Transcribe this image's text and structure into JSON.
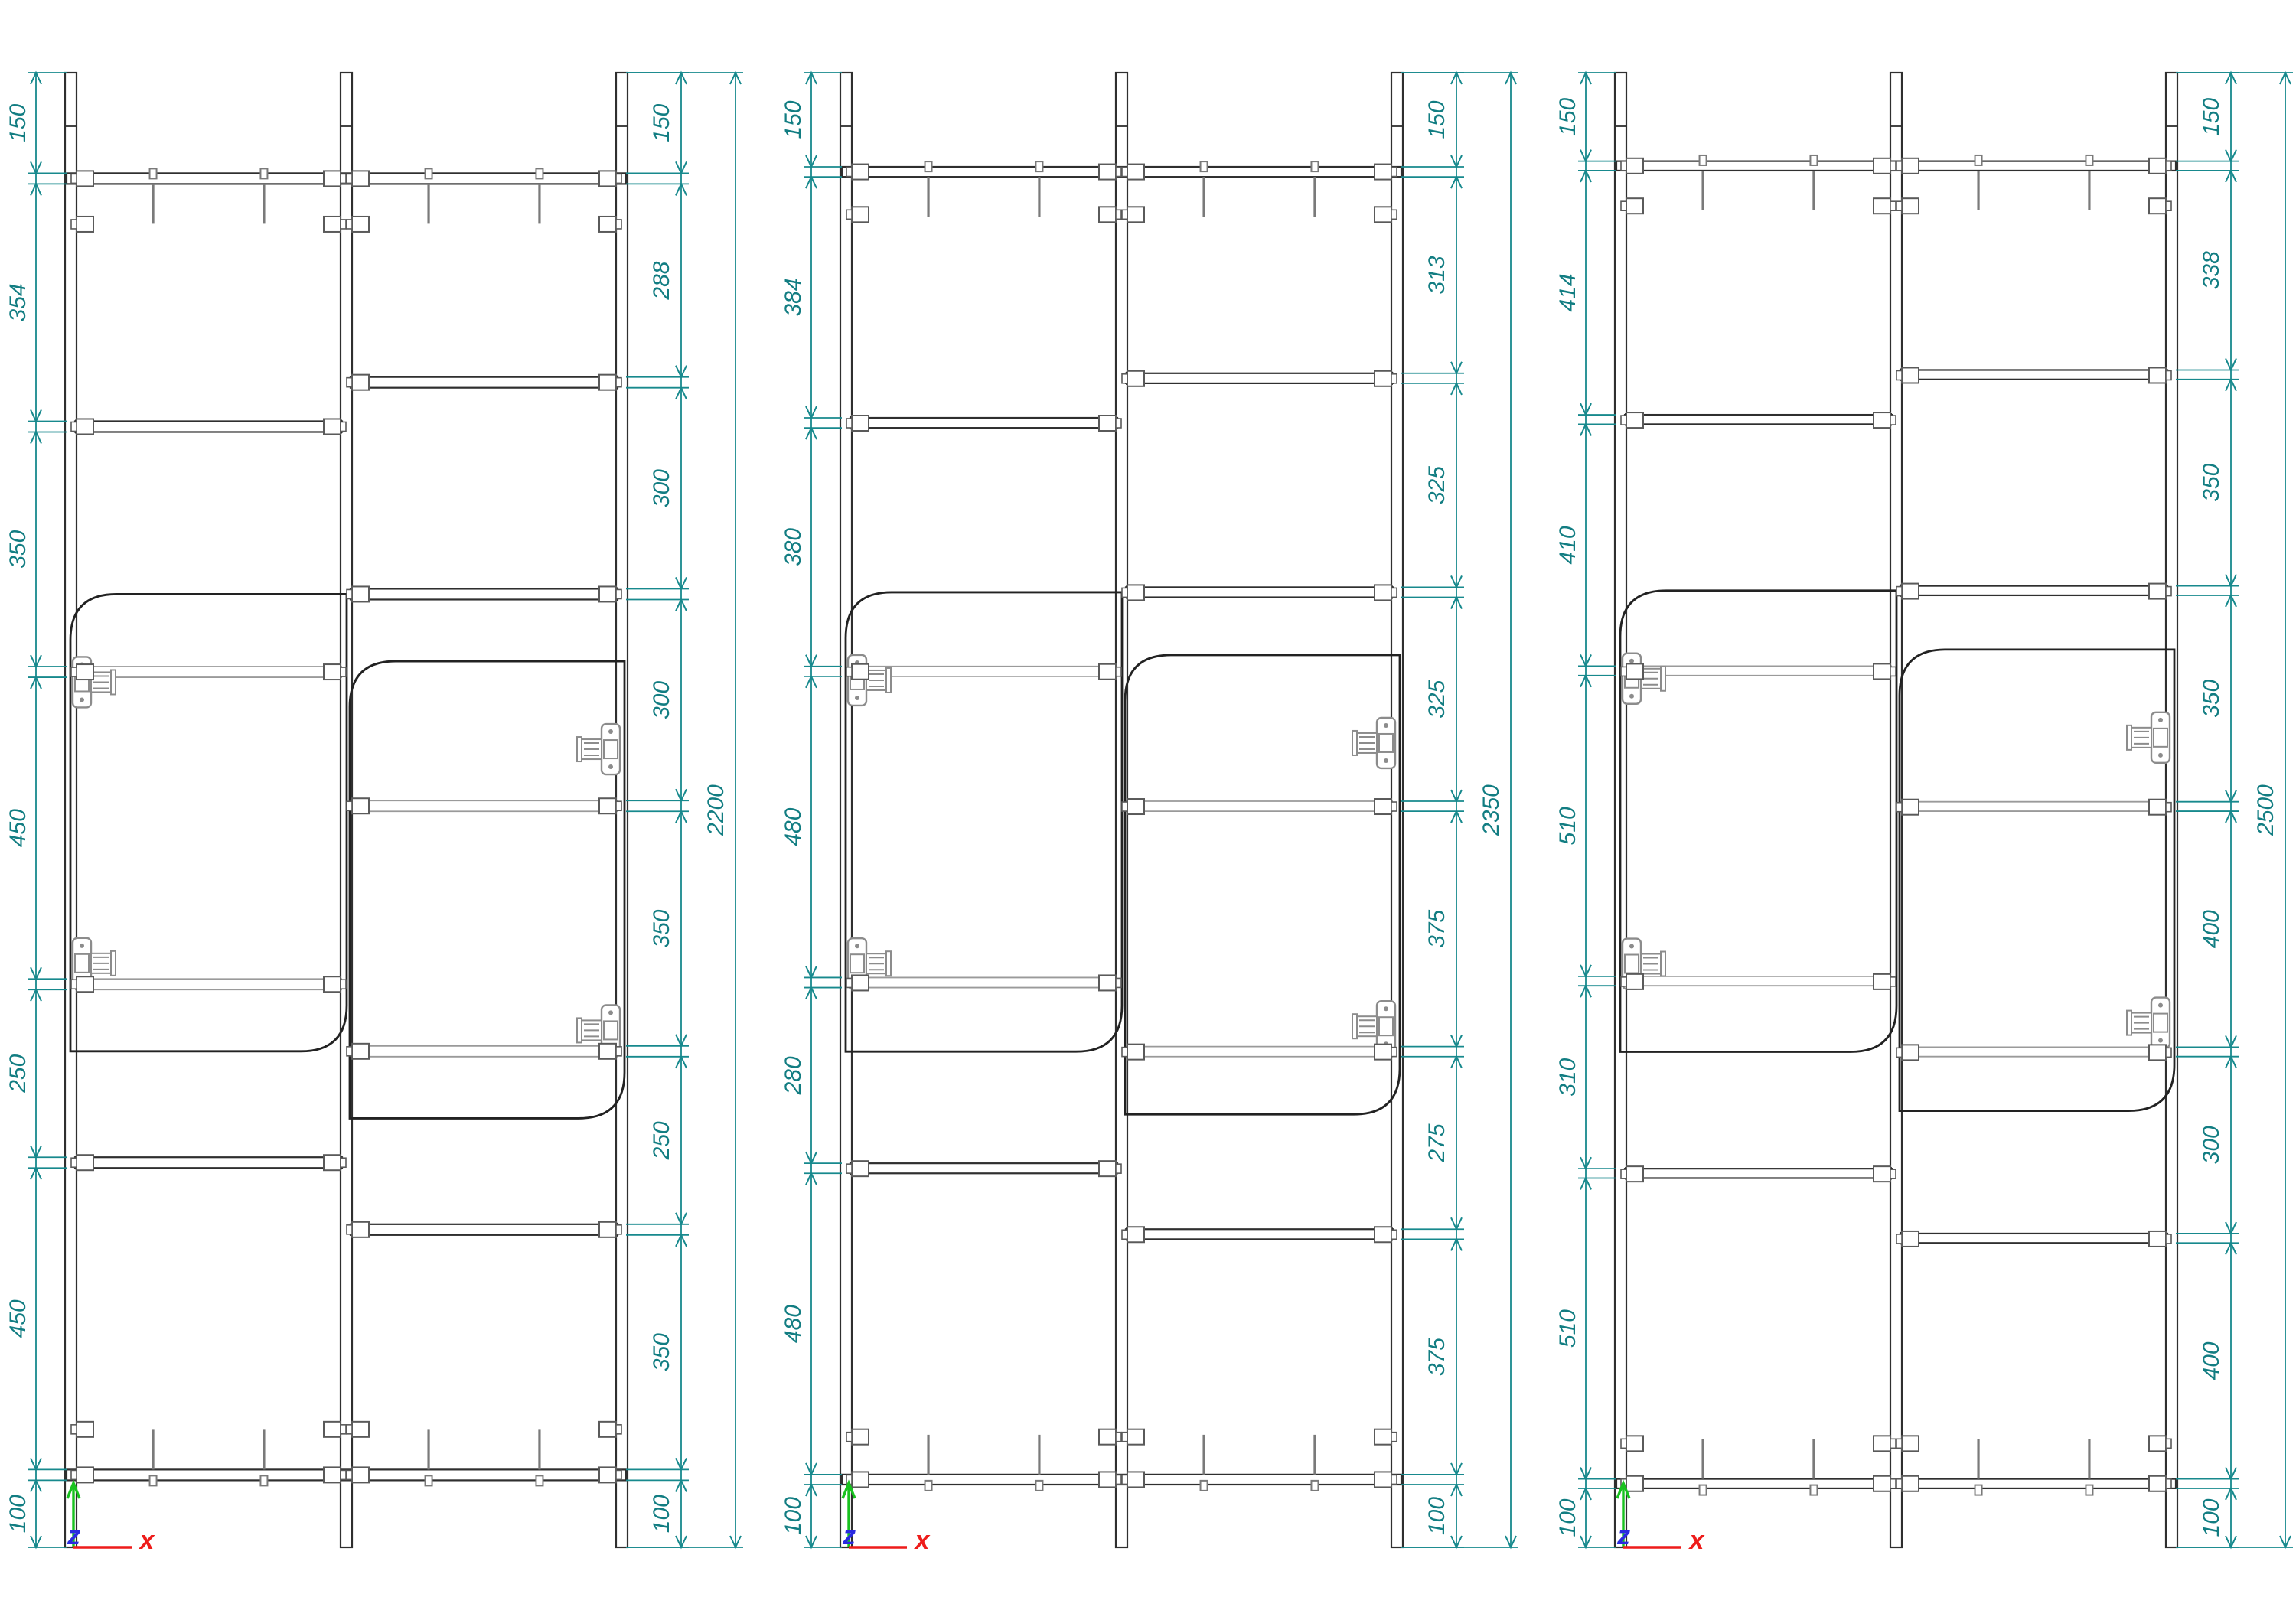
{
  "colors": {
    "dimension": "#17898d",
    "drawing_line": "#2f2f2f",
    "hidden_line": "#9a9a9a",
    "hardware": "#8c8c8c",
    "pin": "#5a5a5a",
    "axis_x": "#ee1c1a",
    "axis_y": "#19c21f",
    "axis_z": "#2a2ae0"
  },
  "axis_labels": {
    "x": "x",
    "z": "z"
  },
  "shelf_thickness_mm": 16,
  "drawings": [
    {
      "name": "elevation-2200",
      "overall_height": "2200",
      "left_bay_dims": [
        "150",
        "354",
        "350",
        "450",
        "250",
        "450",
        "100"
      ],
      "right_bay_dims": [
        "150",
        "288",
        "300",
        "300",
        "350",
        "250",
        "350",
        "100"
      ]
    },
    {
      "name": "elevation-2350",
      "overall_height": "2350",
      "left_bay_dims": [
        "150",
        "384",
        "380",
        "480",
        "280",
        "480",
        "100"
      ],
      "right_bay_dims": [
        "150",
        "313",
        "325",
        "325",
        "375",
        "275",
        "375",
        "100"
      ]
    },
    {
      "name": "elevation-2500",
      "overall_height": "2500",
      "left_bay_dims": [
        "150",
        "414",
        "410",
        "510",
        "310",
        "510",
        "100"
      ],
      "right_bay_dims": [
        "150",
        "338",
        "350",
        "350",
        "400",
        "300",
        "400",
        "100"
      ]
    }
  ]
}
